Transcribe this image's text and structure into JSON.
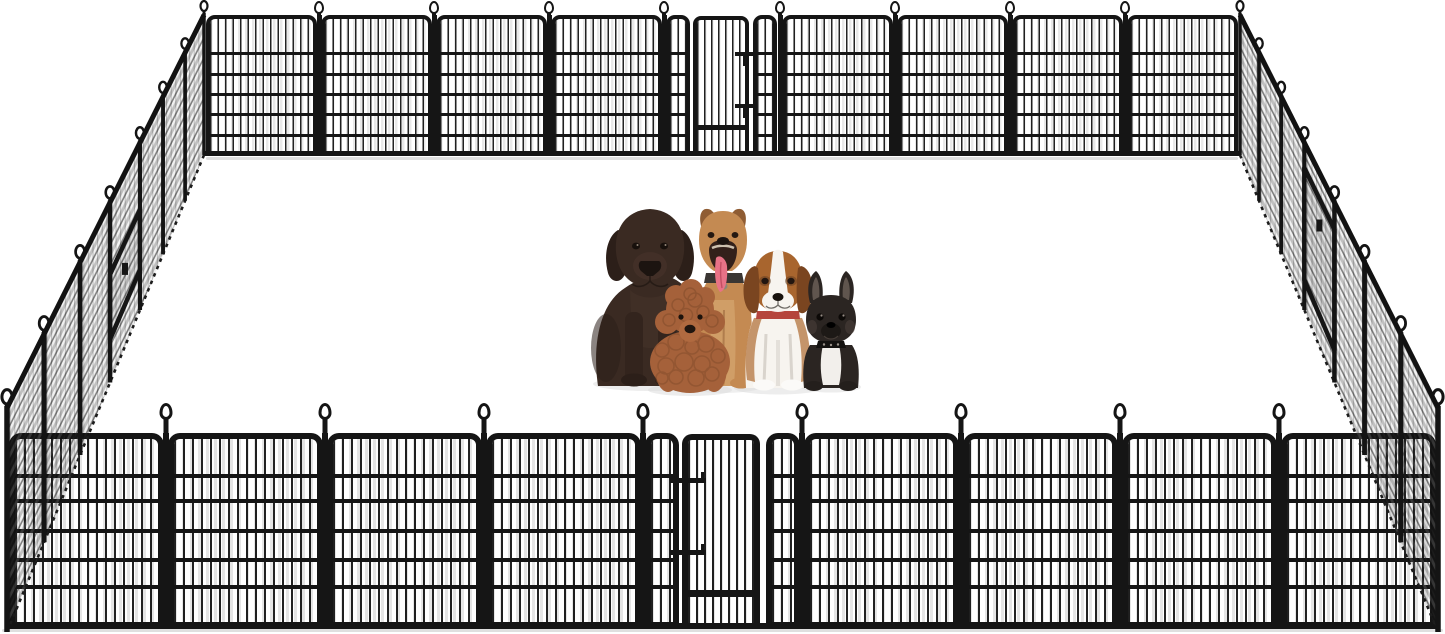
{
  "scene": {
    "kind": "dog-playpen-product-illustration",
    "background_color": "#ffffff",
    "fence": {
      "metal_color": "#151515",
      "wire_color": "#222222",
      "mesh_line_color": "#2e2e2e",
      "mesh_soft_color": "#8f8f8f",
      "ground_shadow_color": "#d7d7d7",
      "back_wall": {
        "panel_count": 9,
        "gate_section_index": 4,
        "has_gate": true
      },
      "front_wall": {
        "panel_count": 9,
        "gate_section_index": 4,
        "has_gate": true
      },
      "left_wall": {
        "panel_count": 7,
        "has_gate": true
      },
      "right_wall": {
        "panel_count": 7,
        "has_gate": true
      },
      "loop_posts_back": 10,
      "loop_posts_front": 10
    },
    "dogs": [
      {
        "name": "chocolate-labrador",
        "color": "#3a2a22",
        "accent": "#2c1f19"
      },
      {
        "name": "tan-pitbull",
        "color": "#c48a52",
        "accent": "#8f5c33",
        "tongue_color": "#e87286"
      },
      {
        "name": "apricot-poodle",
        "color": "#a5613a",
        "accent": "#7f4a2a"
      },
      {
        "name": "beagle",
        "color": "#a8652e",
        "accent": "#7a4520",
        "chest_color": "#f7f4ef",
        "collar_color": "#b5453c"
      },
      {
        "name": "french-bulldog",
        "color": "#2b2522",
        "accent": "#1d1916",
        "chest_color": "#f2efeb"
      }
    ],
    "dog_shadow_color": "#dcdcdc"
  }
}
